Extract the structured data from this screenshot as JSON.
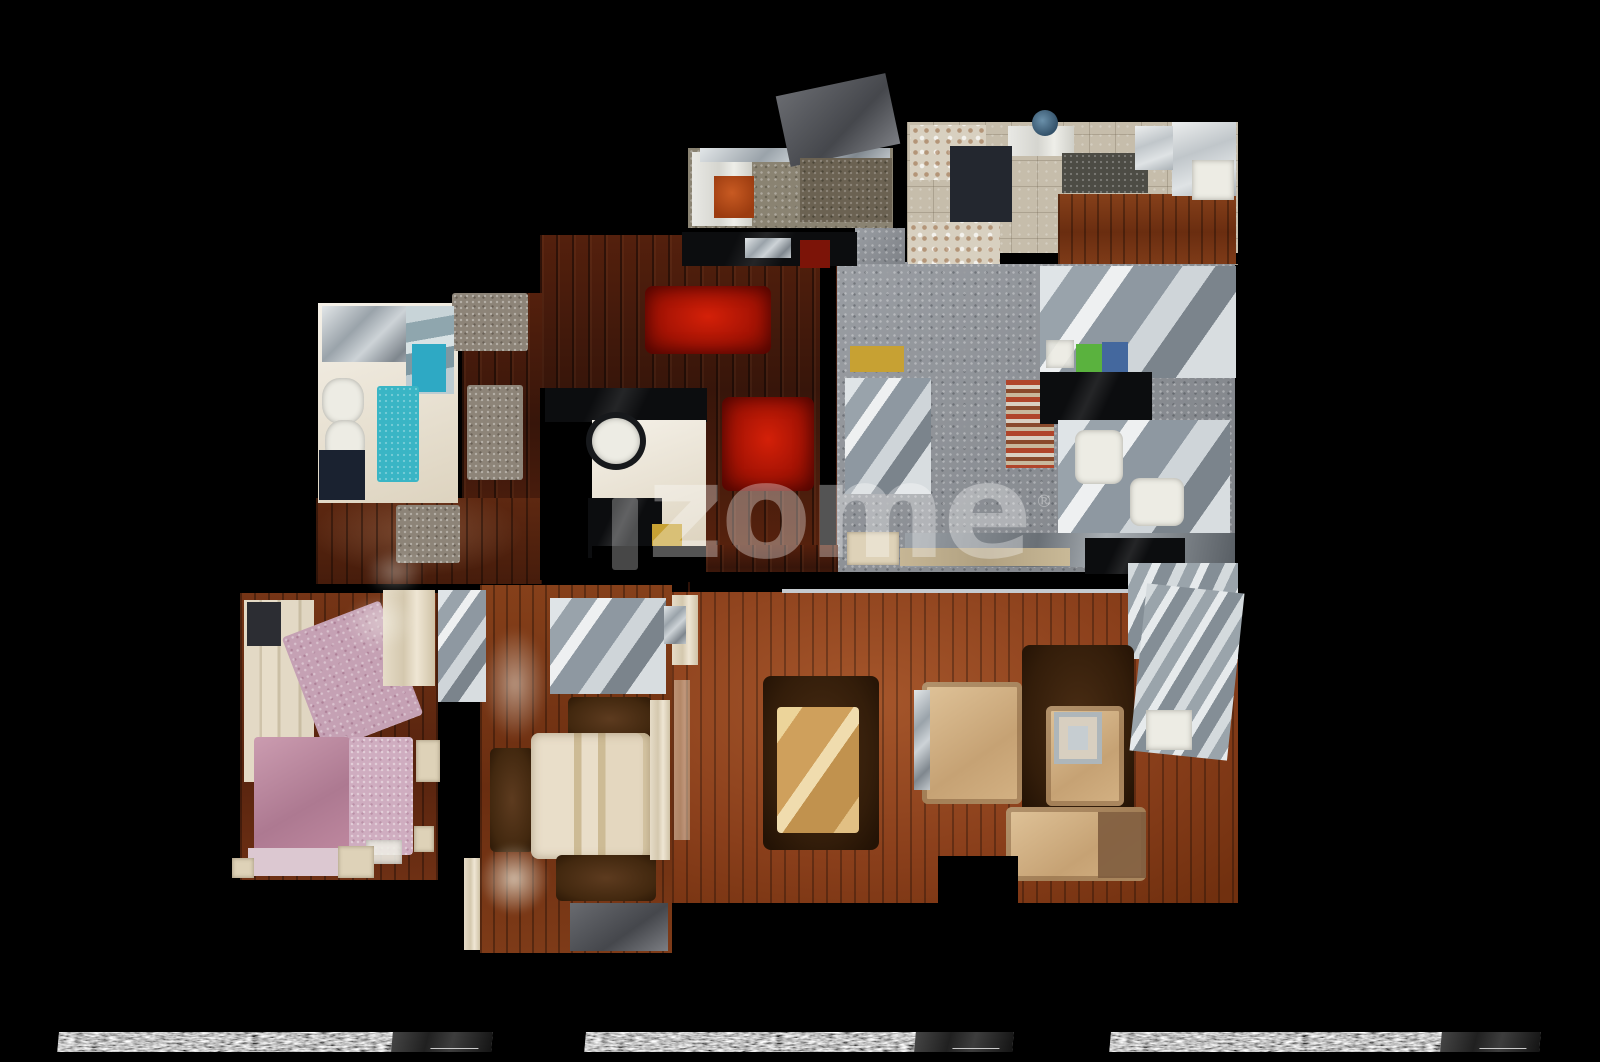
{
  "watermark": {
    "text": "zome",
    "registered": "®"
  },
  "colors": {
    "background": "#000000",
    "watermark": "rgba(255,255,255,0.33)",
    "red_rug": "#a51304",
    "cyan_rug": "#3ab5c5",
    "living_wood": "#8a3f1b",
    "hall_wood": "#4a1d0c",
    "kitchen_tile": "#c6bdab",
    "kitchen_terrazzo": "#8f9399",
    "pink_bed": "#ad7991",
    "sofa_beige": "#c6a274",
    "table_gold": "#cfa05c"
  },
  "scene": {
    "width": 1600,
    "height": 1062,
    "strip_y": 1032,
    "strip_h": 20,
    "strips": [
      {
        "x": 58,
        "w": 434
      },
      {
        "x": 585,
        "w": 428
      },
      {
        "x": 1110,
        "w": 430
      }
    ],
    "elements": [
      {
        "n": "laundry-room-floor",
        "c": "terrazzo-olive",
        "x": 688,
        "y": 148,
        "w": 205,
        "h": 80
      },
      {
        "n": "kitchen-floor",
        "c": "tile-beige",
        "x": 907,
        "y": 122,
        "w": 331,
        "h": 143
      },
      {
        "n": "open-kitchen-floor",
        "c": "terrazzo-gray",
        "x": 835,
        "y": 262,
        "w": 400,
        "h": 312
      },
      {
        "n": "open-kitchen-floor-notch",
        "c": "terrazzo-gray",
        "x": 855,
        "y": 228,
        "w": 50,
        "h": 36
      },
      {
        "n": "wall-kitchens",
        "c": "void",
        "x": 960,
        "y": 253,
        "w": 278,
        "h": 11
      },
      {
        "n": "entry-hall-floor",
        "c": "wood-dark",
        "x": 540,
        "y": 235,
        "w": 297,
        "h": 345
      },
      {
        "n": "wall-hall-kitchen",
        "c": "void",
        "x": 820,
        "y": 262,
        "w": 16,
        "h": 312
      },
      {
        "n": "hall-west-floor",
        "c": "wood-dark",
        "x": 462,
        "y": 293,
        "w": 80,
        "h": 290
      },
      {
        "n": "hall-south-floor",
        "c": "wood-dark2",
        "x": 316,
        "y": 498,
        "w": 226,
        "h": 86
      },
      {
        "n": "bathroom-floor",
        "c": "cream",
        "x": 318,
        "y": 303,
        "w": 140,
        "h": 200
      },
      {
        "n": "bedroom1-floor",
        "c": "wood-mid",
        "x": 240,
        "y": 593,
        "w": 198,
        "h": 287
      },
      {
        "n": "bedroom2-floor",
        "c": "wood-warm",
        "x": 480,
        "y": 585,
        "w": 192,
        "h": 368
      },
      {
        "n": "hall-living-bridge",
        "c": "wood-dark",
        "x": 688,
        "y": 545,
        "w": 150,
        "h": 50
      },
      {
        "n": "living-room-floor",
        "c": "wood-living",
        "x": 672,
        "y": 592,
        "w": 566,
        "h": 311
      },
      {
        "n": "living-top-wall",
        "c": "void",
        "x": 690,
        "y": 572,
        "w": 548,
        "h": 20
      },
      {
        "n": "living-top-trim",
        "c": "trim-silver",
        "x": 782,
        "y": 589,
        "w": 452,
        "h": 4
      },
      {
        "n": "washer-column",
        "c": "appliance-white",
        "x": 692,
        "y": 152,
        "w": 60,
        "h": 74
      },
      {
        "n": "laundry-counter-top",
        "c": "silver",
        "x": 700,
        "y": 148,
        "w": 190,
        "h": 14
      },
      {
        "n": "drying-rack",
        "c": "slate",
        "x": 782,
        "y": 84,
        "w": 112,
        "h": 72,
        "r": -12
      },
      {
        "n": "laundry-basket-orange",
        "c": "rust",
        "x": 714,
        "y": 176,
        "w": 40,
        "h": 42
      },
      {
        "n": "laundry-floor-dark-patch",
        "c": "olive-dark",
        "x": 800,
        "y": 158,
        "w": 92,
        "h": 64
      },
      {
        "n": "hall-top-cabinet",
        "c": "black-gloss",
        "x": 682,
        "y": 232,
        "w": 175,
        "h": 34
      },
      {
        "n": "hall-top-chrome",
        "c": "silver",
        "x": 745,
        "y": 238,
        "w": 46,
        "h": 20
      },
      {
        "n": "hall-top-red-item",
        "c": "darkred",
        "x": 800,
        "y": 240,
        "w": 30,
        "h": 28
      },
      {
        "n": "kitchen-shelf-clutter-top",
        "c": "clutter",
        "x": 910,
        "y": 125,
        "w": 76,
        "h": 55
      },
      {
        "n": "kitchen-shelf-clutter-bottom",
        "c": "clutter",
        "x": 908,
        "y": 222,
        "w": 92,
        "h": 42
      },
      {
        "n": "kitchen-white-goods",
        "c": "appliance-white",
        "x": 1008,
        "y": 126,
        "w": 66,
        "h": 30
      },
      {
        "n": "kitchen-navy-rug",
        "c": "navy",
        "x": 950,
        "y": 146,
        "w": 62,
        "h": 76
      },
      {
        "n": "kitchen-pot",
        "c": "steel-blue",
        "x": 1032,
        "y": 110,
        "w": 26,
        "h": 26,
        "br": "50%"
      },
      {
        "n": "kitchen-granite-counter",
        "c": "granite-dark",
        "x": 1062,
        "y": 153,
        "w": 86,
        "h": 40
      },
      {
        "n": "kitchen-wood-table",
        "c": "wood-warm",
        "x": 1058,
        "y": 194,
        "w": 178,
        "h": 70
      },
      {
        "n": "kitchen-fridge",
        "c": "silver-light",
        "x": 1172,
        "y": 122,
        "w": 64,
        "h": 74
      },
      {
        "n": "kitchen-sink-white",
        "c": "white-soft",
        "x": 1192,
        "y": 160,
        "w": 42,
        "h": 40
      },
      {
        "n": "kitchen-chrome-right",
        "c": "silver-light",
        "x": 1135,
        "y": 126,
        "w": 38,
        "h": 44
      },
      {
        "n": "ok-counter-topright",
        "c": "silver-mix",
        "x": 1040,
        "y": 266,
        "w": 196,
        "h": 112
      },
      {
        "n": "ok-chrome-left",
        "c": "silver-mix",
        "x": 845,
        "y": 378,
        "w": 86,
        "h": 116
      },
      {
        "n": "ok-yellow-item",
        "c": "mustard",
        "x": 850,
        "y": 346,
        "w": 54,
        "h": 26
      },
      {
        "n": "ok-striped-rug",
        "c": "stripes-warm",
        "x": 1006,
        "y": 380,
        "w": 48,
        "h": 88
      },
      {
        "n": "ok-dark-counter",
        "c": "black-gloss",
        "x": 1040,
        "y": 372,
        "w": 112,
        "h": 52
      },
      {
        "n": "ok-white-sheet",
        "c": "white-soft",
        "x": 1046,
        "y": 340,
        "w": 28,
        "h": 28,
        "o": 0.9
      },
      {
        "n": "ok-green-board",
        "c": "green",
        "x": 1076,
        "y": 344,
        "w": 28,
        "h": 28
      },
      {
        "n": "ok-blue-cloth",
        "c": "denim",
        "x": 1102,
        "y": 342,
        "w": 26,
        "h": 30
      },
      {
        "n": "ok-dining-chrome",
        "c": "silver-mix",
        "x": 1058,
        "y": 420,
        "w": 172,
        "h": 140
      },
      {
        "n": "ok-chair-white-1",
        "c": "white-soft",
        "x": 1075,
        "y": 430,
        "w": 48,
        "h": 54,
        "br": "10px"
      },
      {
        "n": "ok-chair-white-2",
        "c": "white-soft",
        "x": 1130,
        "y": 478,
        "w": 54,
        "h": 48,
        "br": "10px"
      },
      {
        "n": "ok-bottom-band",
        "c": "silver-dark",
        "x": 905,
        "y": 533,
        "w": 330,
        "h": 34
      },
      {
        "n": "ok-bottom-appliance",
        "c": "black-gloss",
        "x": 1085,
        "y": 538,
        "w": 100,
        "h": 36
      },
      {
        "n": "ok-bottom-beige-box",
        "c": "cream-obj",
        "x": 847,
        "y": 532,
        "w": 52,
        "h": 33
      },
      {
        "n": "red-rug-hall",
        "c": "shag-red",
        "x": 645,
        "y": 286,
        "w": 126,
        "h": 68
      },
      {
        "n": "red-rug-hall-2",
        "c": "shag-red",
        "x": 722,
        "y": 397,
        "w": 92,
        "h": 94
      },
      {
        "n": "hall-gray-mat-top",
        "c": "rug-taupe",
        "x": 452,
        "y": 293,
        "w": 76,
        "h": 58
      },
      {
        "n": "hall-runner-rug",
        "c": "rug-taupe",
        "x": 467,
        "y": 385,
        "w": 56,
        "h": 95
      },
      {
        "n": "hall-south-rug",
        "c": "rug-taupe",
        "x": 396,
        "y": 505,
        "w": 64,
        "h": 58
      },
      {
        "n": "hall-west-wall",
        "c": "void",
        "x": 540,
        "y": 388,
        "w": 52,
        "h": 192
      },
      {
        "n": "bathroom2-counter",
        "c": "black-gloss",
        "x": 545,
        "y": 388,
        "w": 162,
        "h": 34
      },
      {
        "n": "bathroom2-floor",
        "c": "cream",
        "x": 592,
        "y": 420,
        "w": 114,
        "h": 126
      },
      {
        "n": "bathroom2-sink-ring",
        "c": "ring-dark",
        "x": 586,
        "y": 412,
        "w": 60,
        "h": 58,
        "br": "50%"
      },
      {
        "n": "bathroom2-sink",
        "c": "white-soft",
        "x": 592,
        "y": 418,
        "w": 48,
        "h": 46,
        "br": "50%"
      },
      {
        "n": "bathroom2-dark-unit",
        "c": "black-gloss",
        "x": 588,
        "y": 498,
        "w": 74,
        "h": 60
      },
      {
        "n": "bathroom2-yellow-item",
        "c": "mustard",
        "x": 652,
        "y": 524,
        "w": 30,
        "h": 24
      },
      {
        "n": "bathroom2-south-wall",
        "c": "void",
        "x": 592,
        "y": 546,
        "w": 114,
        "h": 36
      },
      {
        "n": "bathtub",
        "c": "silver",
        "x": 322,
        "y": 306,
        "w": 102,
        "h": 56
      },
      {
        "n": "shower-glass",
        "c": "glass-blue",
        "x": 406,
        "y": 306,
        "w": 48,
        "h": 88
      },
      {
        "n": "cyan-towel",
        "c": "cyan-bright",
        "x": 412,
        "y": 344,
        "w": 34,
        "h": 48
      },
      {
        "n": "cyan-bath-rug",
        "c": "cyan",
        "x": 377,
        "y": 386,
        "w": 42,
        "h": 96
      },
      {
        "n": "toilet",
        "c": "white-soft",
        "x": 322,
        "y": 378,
        "w": 42,
        "h": 46,
        "br": "42%"
      },
      {
        "n": "bidet",
        "c": "white-soft",
        "x": 325,
        "y": 420,
        "w": 40,
        "h": 46,
        "br": "42%"
      },
      {
        "n": "navy-bath-mat",
        "c": "navy-dark",
        "x": 319,
        "y": 450,
        "w": 46,
        "h": 50
      },
      {
        "n": "wardrobe-bed1",
        "c": "wardrobe-cream",
        "x": 244,
        "y": 600,
        "w": 70,
        "h": 182
      },
      {
        "n": "wardrobe-dark-shelf",
        "c": "slate-dark",
        "x": 247,
        "y": 602,
        "w": 34,
        "h": 44
      },
      {
        "n": "pink-rug-rotated",
        "c": "pink-rug",
        "x": 300,
        "y": 615,
        "w": 105,
        "h": 122,
        "r": -21
      },
      {
        "n": "mirror-closet-bed1",
        "c": "cream-streak",
        "x": 383,
        "y": 590,
        "w": 52,
        "h": 96
      },
      {
        "n": "bed1-ghost",
        "c": "ghost",
        "x": 345,
        "y": 595,
        "w": 70,
        "h": 55,
        "o": 0.45
      },
      {
        "n": "pink-bed",
        "c": "pink-bed",
        "x": 254,
        "y": 737,
        "w": 96,
        "h": 128
      },
      {
        "n": "pink-bed-sheets",
        "c": "pink-light",
        "x": 248,
        "y": 848,
        "w": 104,
        "h": 28
      },
      {
        "n": "pink-rug-2",
        "c": "pink-rug2",
        "x": 349,
        "y": 737,
        "w": 64,
        "h": 118
      },
      {
        "n": "bed1-white-sheet",
        "c": "white-soft",
        "x": 366,
        "y": 840,
        "w": 36,
        "h": 24,
        "o": 0.9
      },
      {
        "n": "nightstand-bed1",
        "c": "cream-obj",
        "x": 338,
        "y": 846,
        "w": 36,
        "h": 32
      },
      {
        "n": "bed1-white-obj",
        "c": "cream-obj",
        "x": 416,
        "y": 740,
        "w": 24,
        "h": 42
      },
      {
        "n": "bed1-white-obj-2",
        "c": "cream-obj",
        "x": 414,
        "y": 826,
        "w": 20,
        "h": 26
      },
      {
        "n": "bed1-door-step",
        "c": "cream-obj",
        "x": 232,
        "y": 858,
        "w": 22,
        "h": 20
      },
      {
        "n": "closet-mirror-chrome",
        "c": "silver-mix",
        "x": 438,
        "y": 590,
        "w": 48,
        "h": 112
      },
      {
        "n": "closet-white-bottom",
        "c": "cream-streak",
        "x": 464,
        "y": 858,
        "w": 16,
        "h": 92
      },
      {
        "n": "bed2-chrome-desk",
        "c": "silver-mix",
        "x": 550,
        "y": 598,
        "w": 116,
        "h": 96
      },
      {
        "n": "bed2-ghost",
        "c": "ghost",
        "x": 483,
        "y": 628,
        "w": 64,
        "h": 112,
        "o": 0.55
      },
      {
        "n": "bed2-rug-top",
        "c": "shag-brown",
        "x": 568,
        "y": 697,
        "w": 84,
        "h": 44
      },
      {
        "n": "bed2-rug-left",
        "c": "shag-brown",
        "x": 490,
        "y": 748,
        "w": 44,
        "h": 104
      },
      {
        "n": "bed2-bed",
        "c": "bed-cream",
        "x": 531,
        "y": 733,
        "w": 120,
        "h": 126
      },
      {
        "n": "bed2-rug-bottom",
        "c": "shag-brown",
        "x": 556,
        "y": 855,
        "w": 100,
        "h": 46
      },
      {
        "n": "bed2-curtain",
        "c": "cream-streak",
        "x": 650,
        "y": 700,
        "w": 20,
        "h": 160
      },
      {
        "n": "bed2-sheets-floor",
        "c": "ghost-cream",
        "x": 479,
        "y": 843,
        "w": 70,
        "h": 72,
        "o": 0.8
      },
      {
        "n": "bed2-gray-bench",
        "c": "slate",
        "x": 570,
        "y": 903,
        "w": 98,
        "h": 48
      },
      {
        "n": "ok-beige-counter-bottom",
        "c": "cream-obj-dark",
        "x": 900,
        "y": 548,
        "w": 170,
        "h": 18
      },
      {
        "n": "living-glass-topright",
        "c": "glass-silver",
        "x": 1128,
        "y": 563,
        "w": 110,
        "h": 96
      },
      {
        "n": "living-rug-dining",
        "c": "shag-brown-dark",
        "x": 763,
        "y": 676,
        "w": 116,
        "h": 174
      },
      {
        "n": "dining-table",
        "c": "table-gold",
        "x": 777,
        "y": 707,
        "w": 82,
        "h": 126
      },
      {
        "n": "living-sofa-center",
        "c": "sofa-beige",
        "x": 922,
        "y": 682,
        "w": 100,
        "h": 122
      },
      {
        "n": "living-chrome-strip",
        "c": "silver",
        "x": 914,
        "y": 690,
        "w": 16,
        "h": 100
      },
      {
        "n": "living-rug-tv",
        "c": "shag-brown-dark",
        "x": 1022,
        "y": 645,
        "w": 112,
        "h": 172
      },
      {
        "n": "living-armchair",
        "c": "sofa-beige",
        "x": 1046,
        "y": 706,
        "w": 78,
        "h": 100
      },
      {
        "n": "living-frame",
        "c": "frame",
        "x": 1054,
        "y": 712,
        "w": 48,
        "h": 52
      },
      {
        "n": "living-sofa-bottom",
        "c": "sofa-beige",
        "x": 1006,
        "y": 807,
        "w": 140,
        "h": 74
      },
      {
        "n": "living-sofa-bottom-shadow",
        "c": "brown-shadow",
        "x": 1098,
        "y": 812,
        "w": 48,
        "h": 66
      },
      {
        "n": "living-glass-right",
        "c": "glass-silver",
        "x": 1138,
        "y": 588,
        "w": 98,
        "h": 168,
        "r": 6
      },
      {
        "n": "living-white-box-right",
        "c": "white-soft",
        "x": 1146,
        "y": 710,
        "w": 46,
        "h": 40
      },
      {
        "n": "living-corner-void",
        "c": "void",
        "x": 938,
        "y": 856,
        "w": 80,
        "h": 50
      },
      {
        "n": "living-curtain-left",
        "c": "cream-streak",
        "x": 672,
        "y": 595,
        "w": 26,
        "h": 70
      },
      {
        "n": "living-curtain-left-2",
        "c": "cream-streak",
        "x": 674,
        "y": 680,
        "w": 16,
        "h": 160,
        "o": 0.5
      },
      {
        "n": "living-chrome-left",
        "c": "silver",
        "x": 664,
        "y": 606,
        "w": 22,
        "h": 38
      },
      {
        "n": "corridor-ghost",
        "c": "ghost",
        "x": 365,
        "y": 550,
        "w": 60,
        "h": 45,
        "o": 0.4
      }
    ]
  }
}
